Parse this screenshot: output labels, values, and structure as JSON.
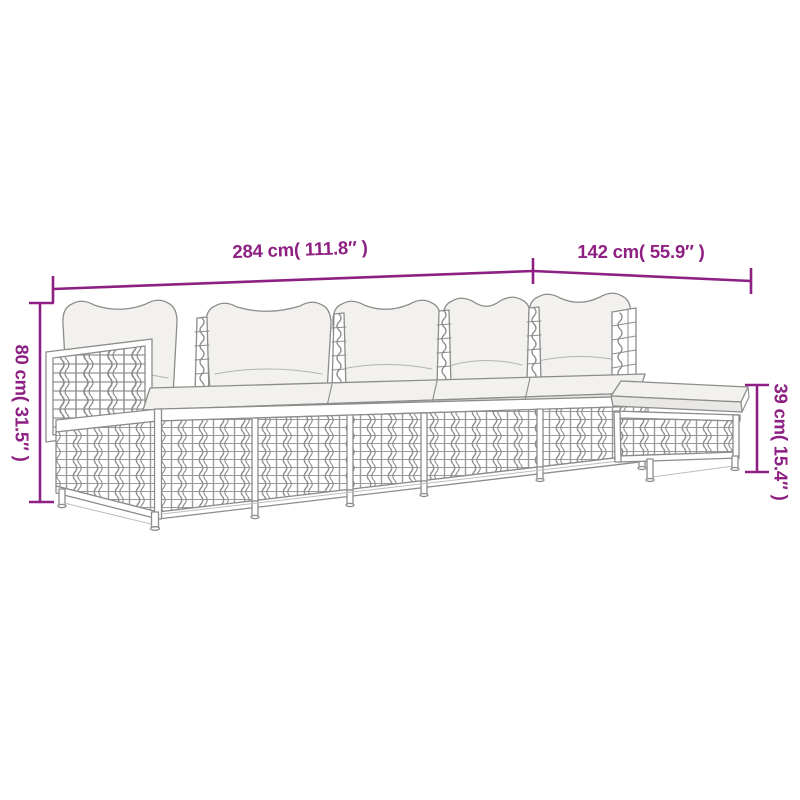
{
  "page": {
    "kind": "product dimension diagram",
    "background_color": "#ffffff"
  },
  "drawing": {
    "subject": "modular poly-rattan lounge set line drawing: four seat modules with back cushions, left armrest panel and a footstool",
    "line_color": "#8c8c8c",
    "cushion_fill_color": "#f2f1ed"
  },
  "dimensions": {
    "accent_color": "#8d2082",
    "total_width": {
      "cm": "284",
      "inch": "111.8",
      "label": "284 cm( 111.8″ )"
    },
    "extension_width": {
      "cm": "142",
      "inch": "55.9",
      "label": "142 cm( 55.9″ )"
    },
    "overall_height": {
      "cm": "80",
      "inch": "31.5",
      "label": "80 cm( 31.5″ )"
    },
    "stool_height": {
      "cm": "39",
      "inch": "15.4",
      "label": "39 cm( 15.4″ )"
    }
  }
}
